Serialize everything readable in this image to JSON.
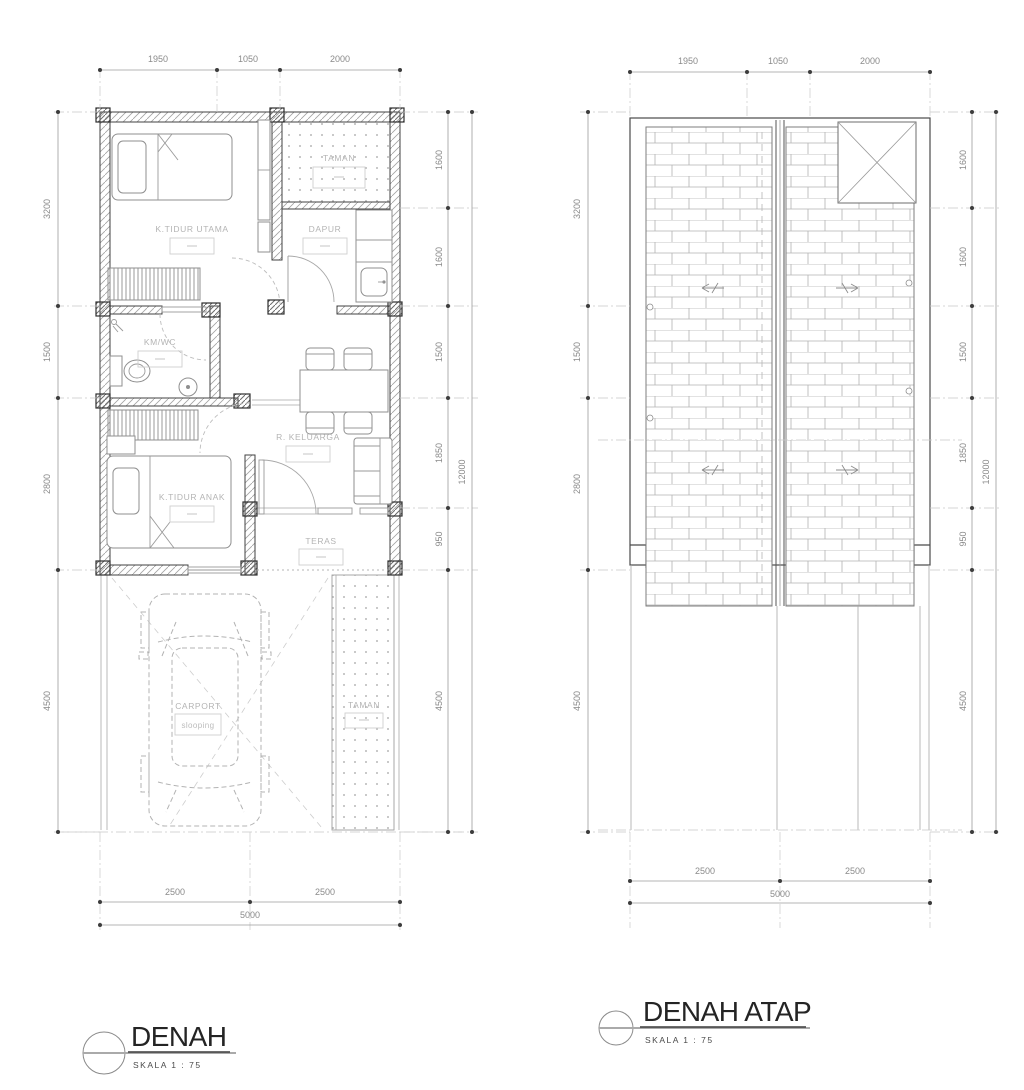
{
  "floor_plan": {
    "title": "DENAH",
    "scale": "SKALA  1 : 75",
    "dims_top": [
      "1950",
      "1050",
      "2000"
    ],
    "dims_left": [
      "3200",
      "1500",
      "2800",
      "4500"
    ],
    "dims_right": [
      "1600",
      "1600",
      "1500",
      "1850",
      "950",
      "4500"
    ],
    "dim_total_right": "12000",
    "dims_bottom": [
      "2500",
      "2500"
    ],
    "dim_bottom_total": "5000",
    "rooms": {
      "master_bedroom": "K.TIDUR  UTAMA",
      "kitchen": "DAPUR",
      "garden_top": "TAMAN",
      "bathroom": "KM/WC",
      "family_room": "R. KELUARGA",
      "kids_bedroom": "K.TIDUR  ANAK",
      "terrace": "TERAS",
      "carport": "CARPORT",
      "carport_note": "slooping",
      "garden_bottom": "TAMAN"
    }
  },
  "roof_plan": {
    "title": "DENAH ATAP",
    "scale": "SKALA  1 : 75",
    "dims_top": [
      "1950",
      "1050",
      "2000"
    ],
    "dims_left": [
      "3200",
      "1500",
      "2800",
      "4500"
    ],
    "dims_right": [
      "1600",
      "1600",
      "1500",
      "1850",
      "950",
      "4500"
    ],
    "dim_total_right": "12000",
    "dims_bottom": [
      "2500",
      "2500"
    ],
    "dim_bottom_total": "5000"
  }
}
